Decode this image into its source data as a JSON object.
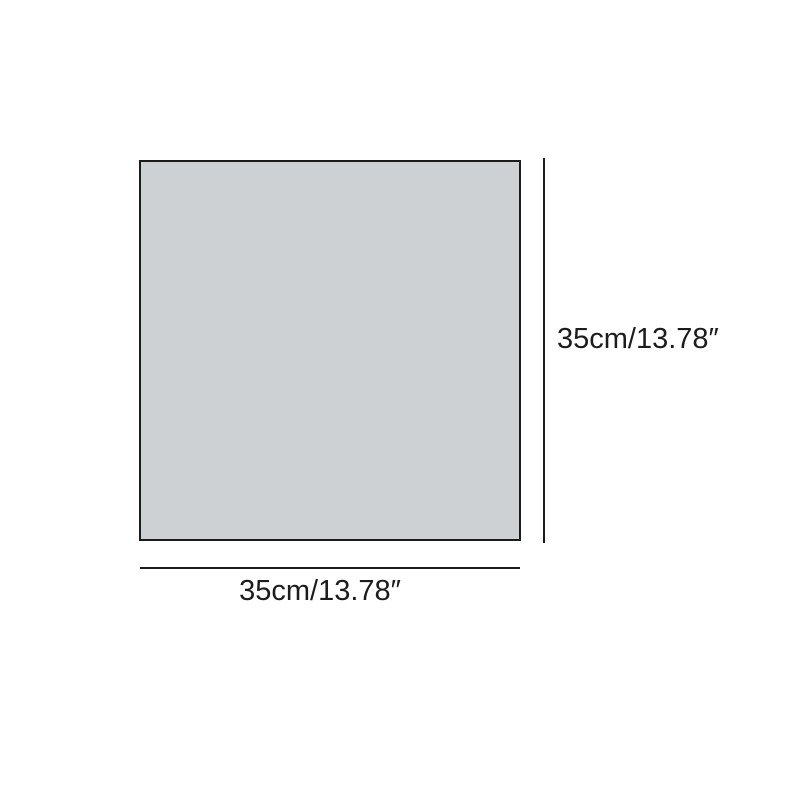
{
  "diagram": {
    "shape": "square",
    "width_label": "35cm/13.78″",
    "height_label": "35cm/13.78″",
    "colors": {
      "background": "#ffffff",
      "square_fill": "#cdd1d4",
      "square_border": "#1c1c1c",
      "dimension_line": "#1c1c1c",
      "label_text": "#1c1c1c"
    }
  }
}
